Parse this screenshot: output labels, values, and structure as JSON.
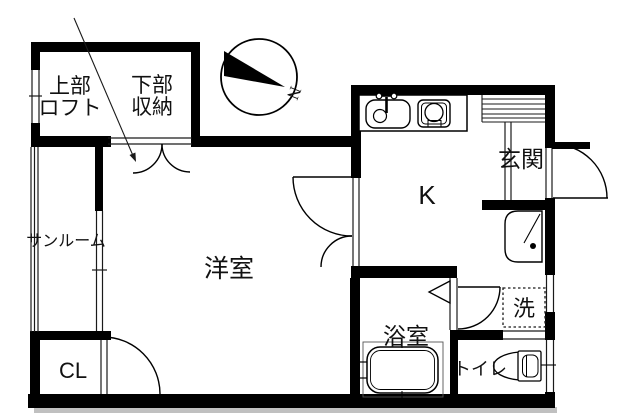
{
  "rooms": {
    "loft": {
      "line1": "上部",
      "line2": "ロフト"
    },
    "storage": {
      "line1": "下部",
      "line2": "収納"
    },
    "sunroom": {
      "label": "サンルーム"
    },
    "western_room": {
      "label": "洋室"
    },
    "closet": {
      "label": "CL"
    },
    "kitchen": {
      "label": "K"
    },
    "entrance": {
      "label": "玄関"
    },
    "bathroom": {
      "label": "浴室"
    },
    "toilet": {
      "label": "トイレ"
    },
    "laundry_pan": {
      "label": "洗"
    }
  },
  "compass": {
    "north_label": "N"
  },
  "colors": {
    "wall": "#000000",
    "line": "#1a1a1a",
    "background": "#ffffff",
    "shadow": "#c0c0c0"
  }
}
